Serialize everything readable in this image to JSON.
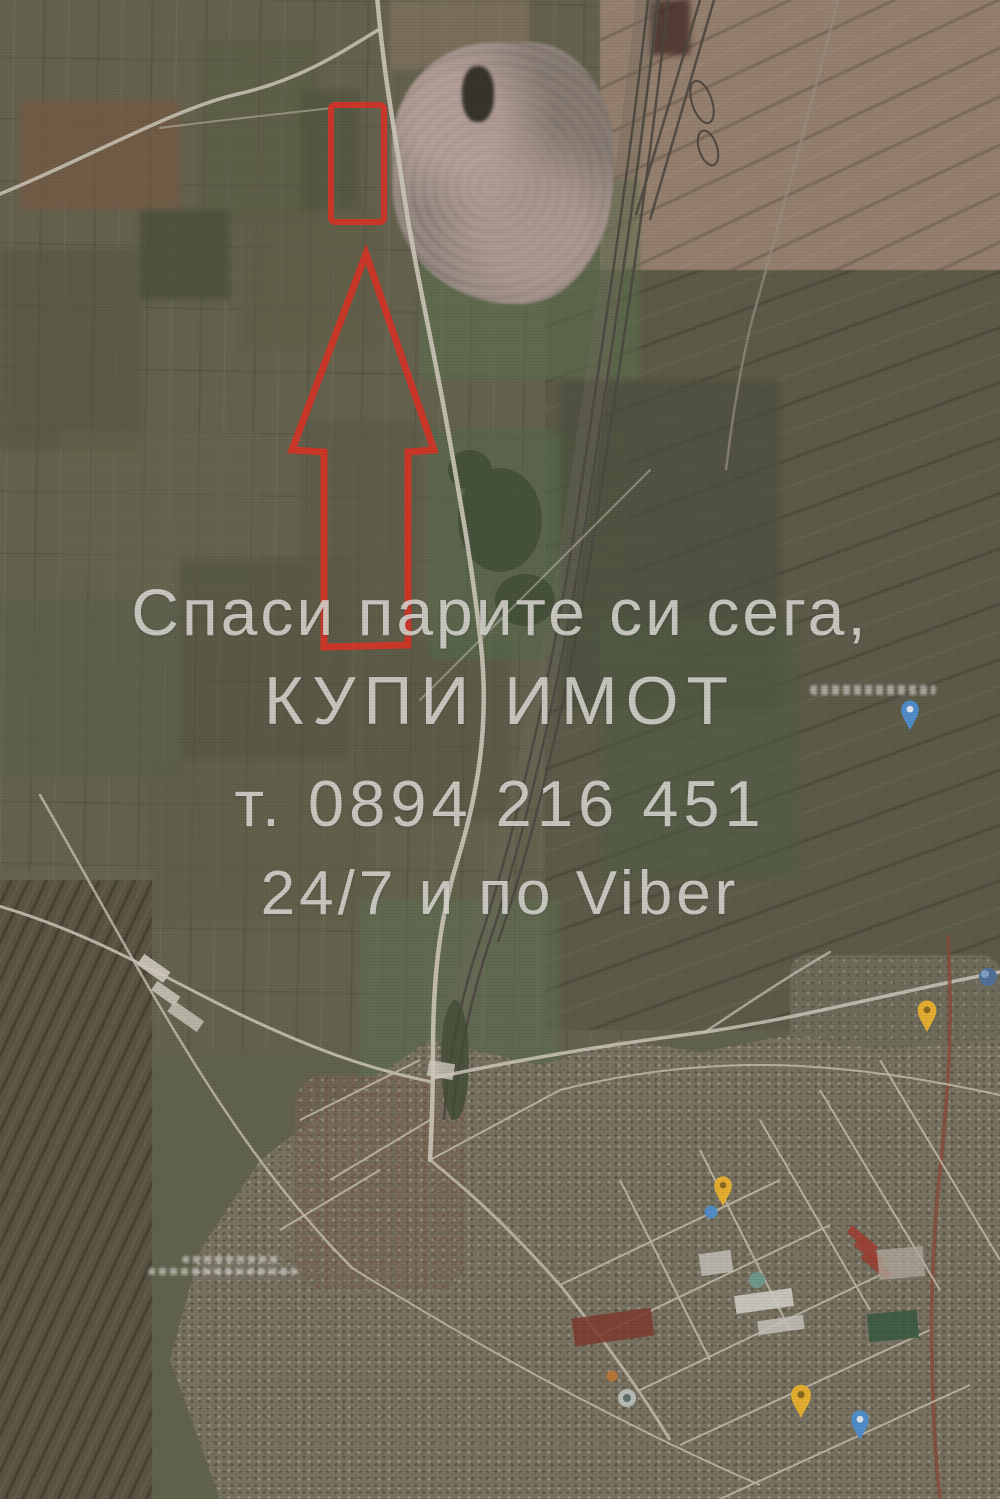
{
  "watermark": {
    "line1": "Спаси парите си сега,",
    "line2": "КУПИ ИМОТ",
    "line3": "т. 0894 216 451",
    "line4": "24/7 и по Viber"
  },
  "colors": {
    "annotation_red": "#e02b1d",
    "watermark_white": "#eeede8",
    "pin_yellow": "#f0b42a",
    "pin_blue": "#4a8fd4",
    "pin_teal": "#6e9d8f",
    "pin_orange": "#c8762f",
    "pin_gray": "#c2c9c4",
    "route_brown": "#8a4432"
  }
}
